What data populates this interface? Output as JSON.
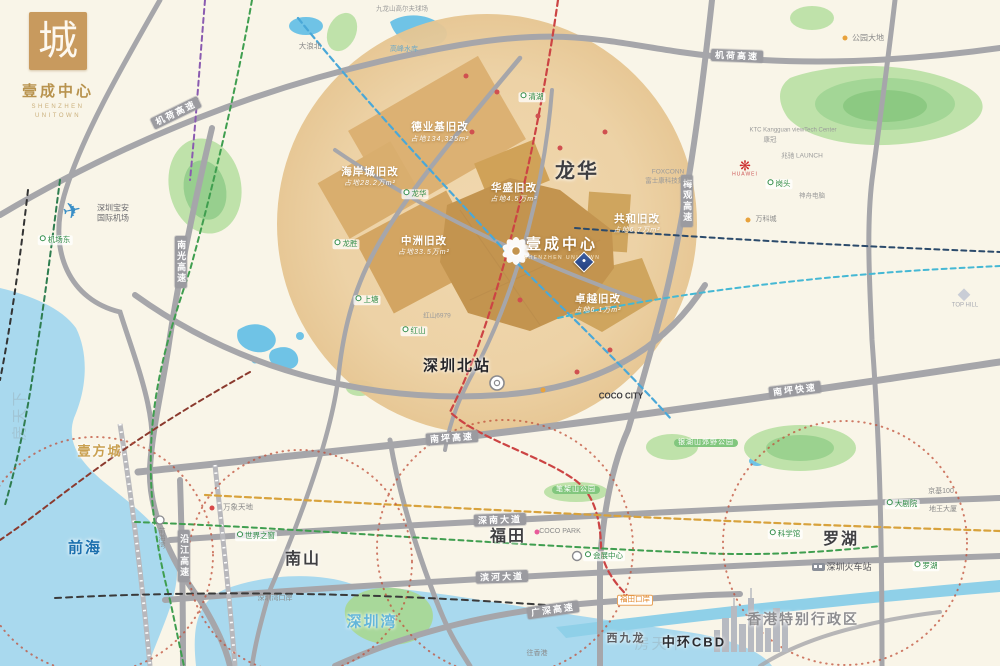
{
  "brand": {
    "logo_char": "城",
    "name": "壹成中心",
    "en1": "SHENZHEN",
    "en2": "UNITOWN"
  },
  "project": {
    "name": "壹成中心",
    "en": "SHENZHEN UNITOWN"
  },
  "colors": {
    "brand_gold": "#c89a5e",
    "block_dark_tan": "#c3944f",
    "circle_tan": "#eed2a6",
    "road_gray": "#a6a6aa",
    "water": "#a9d9ee",
    "park": "#b9e0a6",
    "metro_red": "#cc4444",
    "metro_blue": "#4aa8d8",
    "metro_green": "#3f9e4f",
    "metro_navy": "#2b4a6b",
    "metro_cyan": "#45b8d4",
    "metro_orange": "#d8a23c",
    "dotted_circle": "#c0503a"
  },
  "labels": {
    "big": [
      {
        "t": "龙华",
        "x": 577,
        "y": 172,
        "s": 20,
        "n": "district-longhua"
      },
      {
        "t": "深圳北站",
        "x": 457,
        "y": 366,
        "s": 15,
        "c": "#26262a",
        "n": "shenzhen-north-station"
      },
      {
        "t": "南山",
        "x": 303,
        "y": 560,
        "s": 16,
        "n": "district-nanshan"
      },
      {
        "t": "福田",
        "x": 508,
        "y": 537,
        "s": 16,
        "n": "district-futian"
      },
      {
        "t": "罗湖",
        "x": 841,
        "y": 540,
        "s": 16,
        "n": "district-luohu"
      },
      {
        "t": "前海",
        "x": 85,
        "y": 548,
        "s": 15,
        "c": "#1a6fae",
        "n": "district-qianhai"
      },
      {
        "t": "深圳湾",
        "x": 372,
        "y": 622,
        "s": 15,
        "c": "#63b6da",
        "n": "shenzhen-bay"
      },
      {
        "t": "香港特别行政区",
        "x": 803,
        "y": 619,
        "s": 14,
        "c": "#8d8d90",
        "n": "hongkong-sar"
      },
      {
        "t": "中环CBD",
        "x": 694,
        "y": 643,
        "s": 13,
        "c": "#2a2a2e",
        "n": "central-cbd"
      },
      {
        "t": "西九龙",
        "x": 626,
        "y": 639,
        "s": 11,
        "c": "#5a5a5e",
        "n": "west-kowloon"
      },
      {
        "t": "壹方城",
        "x": 100,
        "y": 452,
        "s": 13,
        "c": "#c9a050",
        "n": "uniworld-mall"
      }
    ],
    "redev": [
      {
        "t": "德业基旧改",
        "x": 440,
        "y": 127
      },
      {
        "t": "占地134,325m²",
        "x": 440,
        "y": 140,
        "s": 7,
        "w": "normal",
        "i": 1
      },
      {
        "t": "海岸城旧改",
        "x": 370,
        "y": 172
      },
      {
        "t": "占地28.2万m²",
        "x": 370,
        "y": 184,
        "s": 7,
        "w": "normal",
        "i": 1
      },
      {
        "t": "中洲旧改",
        "x": 424,
        "y": 241
      },
      {
        "t": "占地33.5万m²",
        "x": 424,
        "y": 253,
        "s": 7,
        "w": "normal",
        "i": 1
      },
      {
        "t": "华盛旧改",
        "x": 514,
        "y": 188
      },
      {
        "t": "占地4.5万m²",
        "x": 514,
        "y": 200,
        "s": 7,
        "w": "normal",
        "i": 1
      },
      {
        "t": "共和旧改",
        "x": 637,
        "y": 219
      },
      {
        "t": "占地6.7万m²",
        "x": 637,
        "y": 231,
        "s": 7,
        "w": "normal",
        "i": 1
      },
      {
        "t": "卓越旧改",
        "x": 598,
        "y": 299
      },
      {
        "t": "占地6.1万m²",
        "x": 598,
        "y": 311,
        "s": 7,
        "w": "normal",
        "i": 1
      }
    ],
    "roads": [
      {
        "t": "机荷高速",
        "x": 176,
        "y": 113,
        "r": -26,
        "n": "jihe-expressway-label"
      },
      {
        "t": "机荷高速",
        "x": 737,
        "y": 56,
        "r": 2,
        "n": "jihe-expressway-label"
      },
      {
        "t": "南光高速",
        "x": 181,
        "y": 262,
        "v": 1,
        "n": "nanguang-expressway-label"
      },
      {
        "t": "梅观高速",
        "x": 687,
        "y": 201,
        "v": 1,
        "n": "meiguan-expressway-label"
      },
      {
        "t": "南坪高速",
        "x": 452,
        "y": 438,
        "r": -4,
        "n": "nanping-expressway-label"
      },
      {
        "t": "南坪快速",
        "x": 795,
        "y": 390,
        "r": -7,
        "n": "nanping-freeway-label"
      },
      {
        "t": "深南大道",
        "x": 500,
        "y": 520,
        "r": -2,
        "n": "shennan-avenue-label"
      },
      {
        "t": "滨河大道",
        "x": 502,
        "y": 577,
        "r": -2,
        "n": "binhe-avenue-label"
      },
      {
        "t": "广深高速",
        "x": 553,
        "y": 610,
        "r": -8,
        "n": "guangshen-expressway-label"
      },
      {
        "t": "沿江高速",
        "x": 184,
        "y": 556,
        "v": 1,
        "n": "yanjiang-expressway-label"
      }
    ],
    "stations": [
      {
        "t": "机场东",
        "x": 55,
        "y": 240
      },
      {
        "t": "清湖",
        "x": 532,
        "y": 97
      },
      {
        "t": "龙华",
        "x": 415,
        "y": 194
      },
      {
        "t": "龙胜",
        "x": 346,
        "y": 244
      },
      {
        "t": "上塘",
        "x": 367,
        "y": 300
      },
      {
        "t": "红山",
        "x": 414,
        "y": 331
      },
      {
        "t": "世界之窗",
        "x": 256,
        "y": 536
      },
      {
        "t": "科学馆",
        "x": 785,
        "y": 534
      },
      {
        "t": "大剧院",
        "x": 902,
        "y": 504
      },
      {
        "t": "罗湖",
        "x": 926,
        "y": 566
      },
      {
        "t": "岗头",
        "x": 779,
        "y": 184
      },
      {
        "t": "会展中心",
        "x": 604,
        "y": 556
      }
    ],
    "badges": [
      {
        "t": "福田口岸",
        "x": 635,
        "y": 600,
        "n": "futian-checkpoint-badge"
      }
    ],
    "pills": [
      {
        "t": "笔架山公园",
        "x": 576,
        "y": 490
      },
      {
        "t": "银湖山郊野公园",
        "x": 706,
        "y": 443
      }
    ],
    "small": [
      {
        "t": "深圳宝安",
        "x": 113,
        "y": 208,
        "s": 8,
        "c": "#6a6a6e"
      },
      {
        "t": "国际机场",
        "x": 113,
        "y": 218,
        "s": 8,
        "c": "#6a6a6e"
      },
      {
        "t": "大浪北",
        "x": 310,
        "y": 47
      },
      {
        "t": "九龙山高尔夫球场",
        "x": 402,
        "y": 9,
        "s": 6.5,
        "c": "#9a9a9a"
      },
      {
        "t": "高峰水库",
        "x": 404,
        "y": 50,
        "s": 7,
        "c": "#6aa7c8"
      },
      {
        "t": "公园大地",
        "x": 868,
        "y": 38,
        "s": 8
      },
      {
        "t": "KTC Kangguan viewTech Center",
        "x": 793,
        "y": 131,
        "s": 6,
        "c": "#9a9a9a"
      },
      {
        "t": "康冠",
        "x": 770,
        "y": 140,
        "s": 6.5,
        "c": "#9a9a9a"
      },
      {
        "t": "兆驰  LAUNCH",
        "x": 802,
        "y": 156,
        "s": 6.5,
        "c": "#9a9a9a"
      },
      {
        "t": "FOXCONN",
        "x": 668,
        "y": 172,
        "s": 6.5,
        "c": "#9a9a9a"
      },
      {
        "t": "富士康科技集团",
        "x": 668,
        "y": 181,
        "s": 6.5,
        "c": "#9a9a9a"
      },
      {
        "t": "神舟电脑",
        "x": 812,
        "y": 196,
        "s": 6.5,
        "c": "#9a9a9a"
      },
      {
        "t": "万科城",
        "x": 766,
        "y": 220,
        "s": 7
      },
      {
        "t": "COCO CITY",
        "x": 621,
        "y": 396,
        "s": 8,
        "c": "#3a3a3e",
        "w": "bold"
      },
      {
        "t": "COCO PARK",
        "x": 560,
        "y": 532,
        "s": 7,
        "c": "#8a8a8a"
      },
      {
        "t": "万象天地",
        "x": 238,
        "y": 508,
        "s": 7.5
      },
      {
        "t": "红山6979",
        "x": 437,
        "y": 316,
        "s": 6.5,
        "c": "#9a9a9a"
      },
      {
        "t": "深圳湾口岸",
        "x": 275,
        "y": 599,
        "s": 7
      },
      {
        "t": "往香港",
        "x": 537,
        "y": 654,
        "s": 7
      },
      {
        "t": "深圳火车站",
        "x": 849,
        "y": 567,
        "s": 9,
        "c": "#55555a"
      },
      {
        "t": "京基100",
        "x": 941,
        "y": 492,
        "s": 7
      },
      {
        "t": "地王大厦",
        "x": 943,
        "y": 510,
        "s": 7
      },
      {
        "t": "前海湾",
        "x": 161,
        "y": 538,
        "s": 7,
        "v": 1
      },
      {
        "t": "TOP HILL",
        "x": 965,
        "y": 306,
        "s": 6,
        "c": "#a8aab2"
      }
    ],
    "dots": [
      {
        "t": "",
        "x": 845,
        "y": 38,
        "bg": "#e8a23c"
      },
      {
        "t": "",
        "x": 748,
        "y": 220,
        "bg": "#e8a23c"
      },
      {
        "t": "",
        "x": 537,
        "y": 532,
        "bg": "#e85a9a"
      },
      {
        "t": "",
        "x": 212,
        "y": 508,
        "bg": "#d84848"
      },
      {
        "t": "",
        "x": 466,
        "y": 76,
        "bg": "#d05050"
      },
      {
        "t": "",
        "x": 497,
        "y": 92,
        "bg": "#d05050"
      },
      {
        "t": "",
        "x": 538,
        "y": 116,
        "bg": "#d05050"
      },
      {
        "t": "",
        "x": 472,
        "y": 132,
        "bg": "#d05050"
      },
      {
        "t": "",
        "x": 560,
        "y": 148,
        "bg": "#d05050"
      },
      {
        "t": "",
        "x": 605,
        "y": 132,
        "bg": "#d05050"
      },
      {
        "t": "",
        "x": 520,
        "y": 300,
        "bg": "#d05050"
      },
      {
        "t": "",
        "x": 577,
        "y": 372,
        "bg": "#d05050"
      },
      {
        "t": "",
        "x": 543,
        "y": 390,
        "bg": "#e8a23c"
      },
      {
        "t": "",
        "x": 610,
        "y": 350,
        "bg": "#d05050"
      }
    ],
    "watermarks": [
      {
        "t": "房天下",
        "x": 20,
        "y": 415,
        "r": -90
      },
      {
        "t": "房天下",
        "x": 660,
        "y": 644
      }
    ]
  }
}
